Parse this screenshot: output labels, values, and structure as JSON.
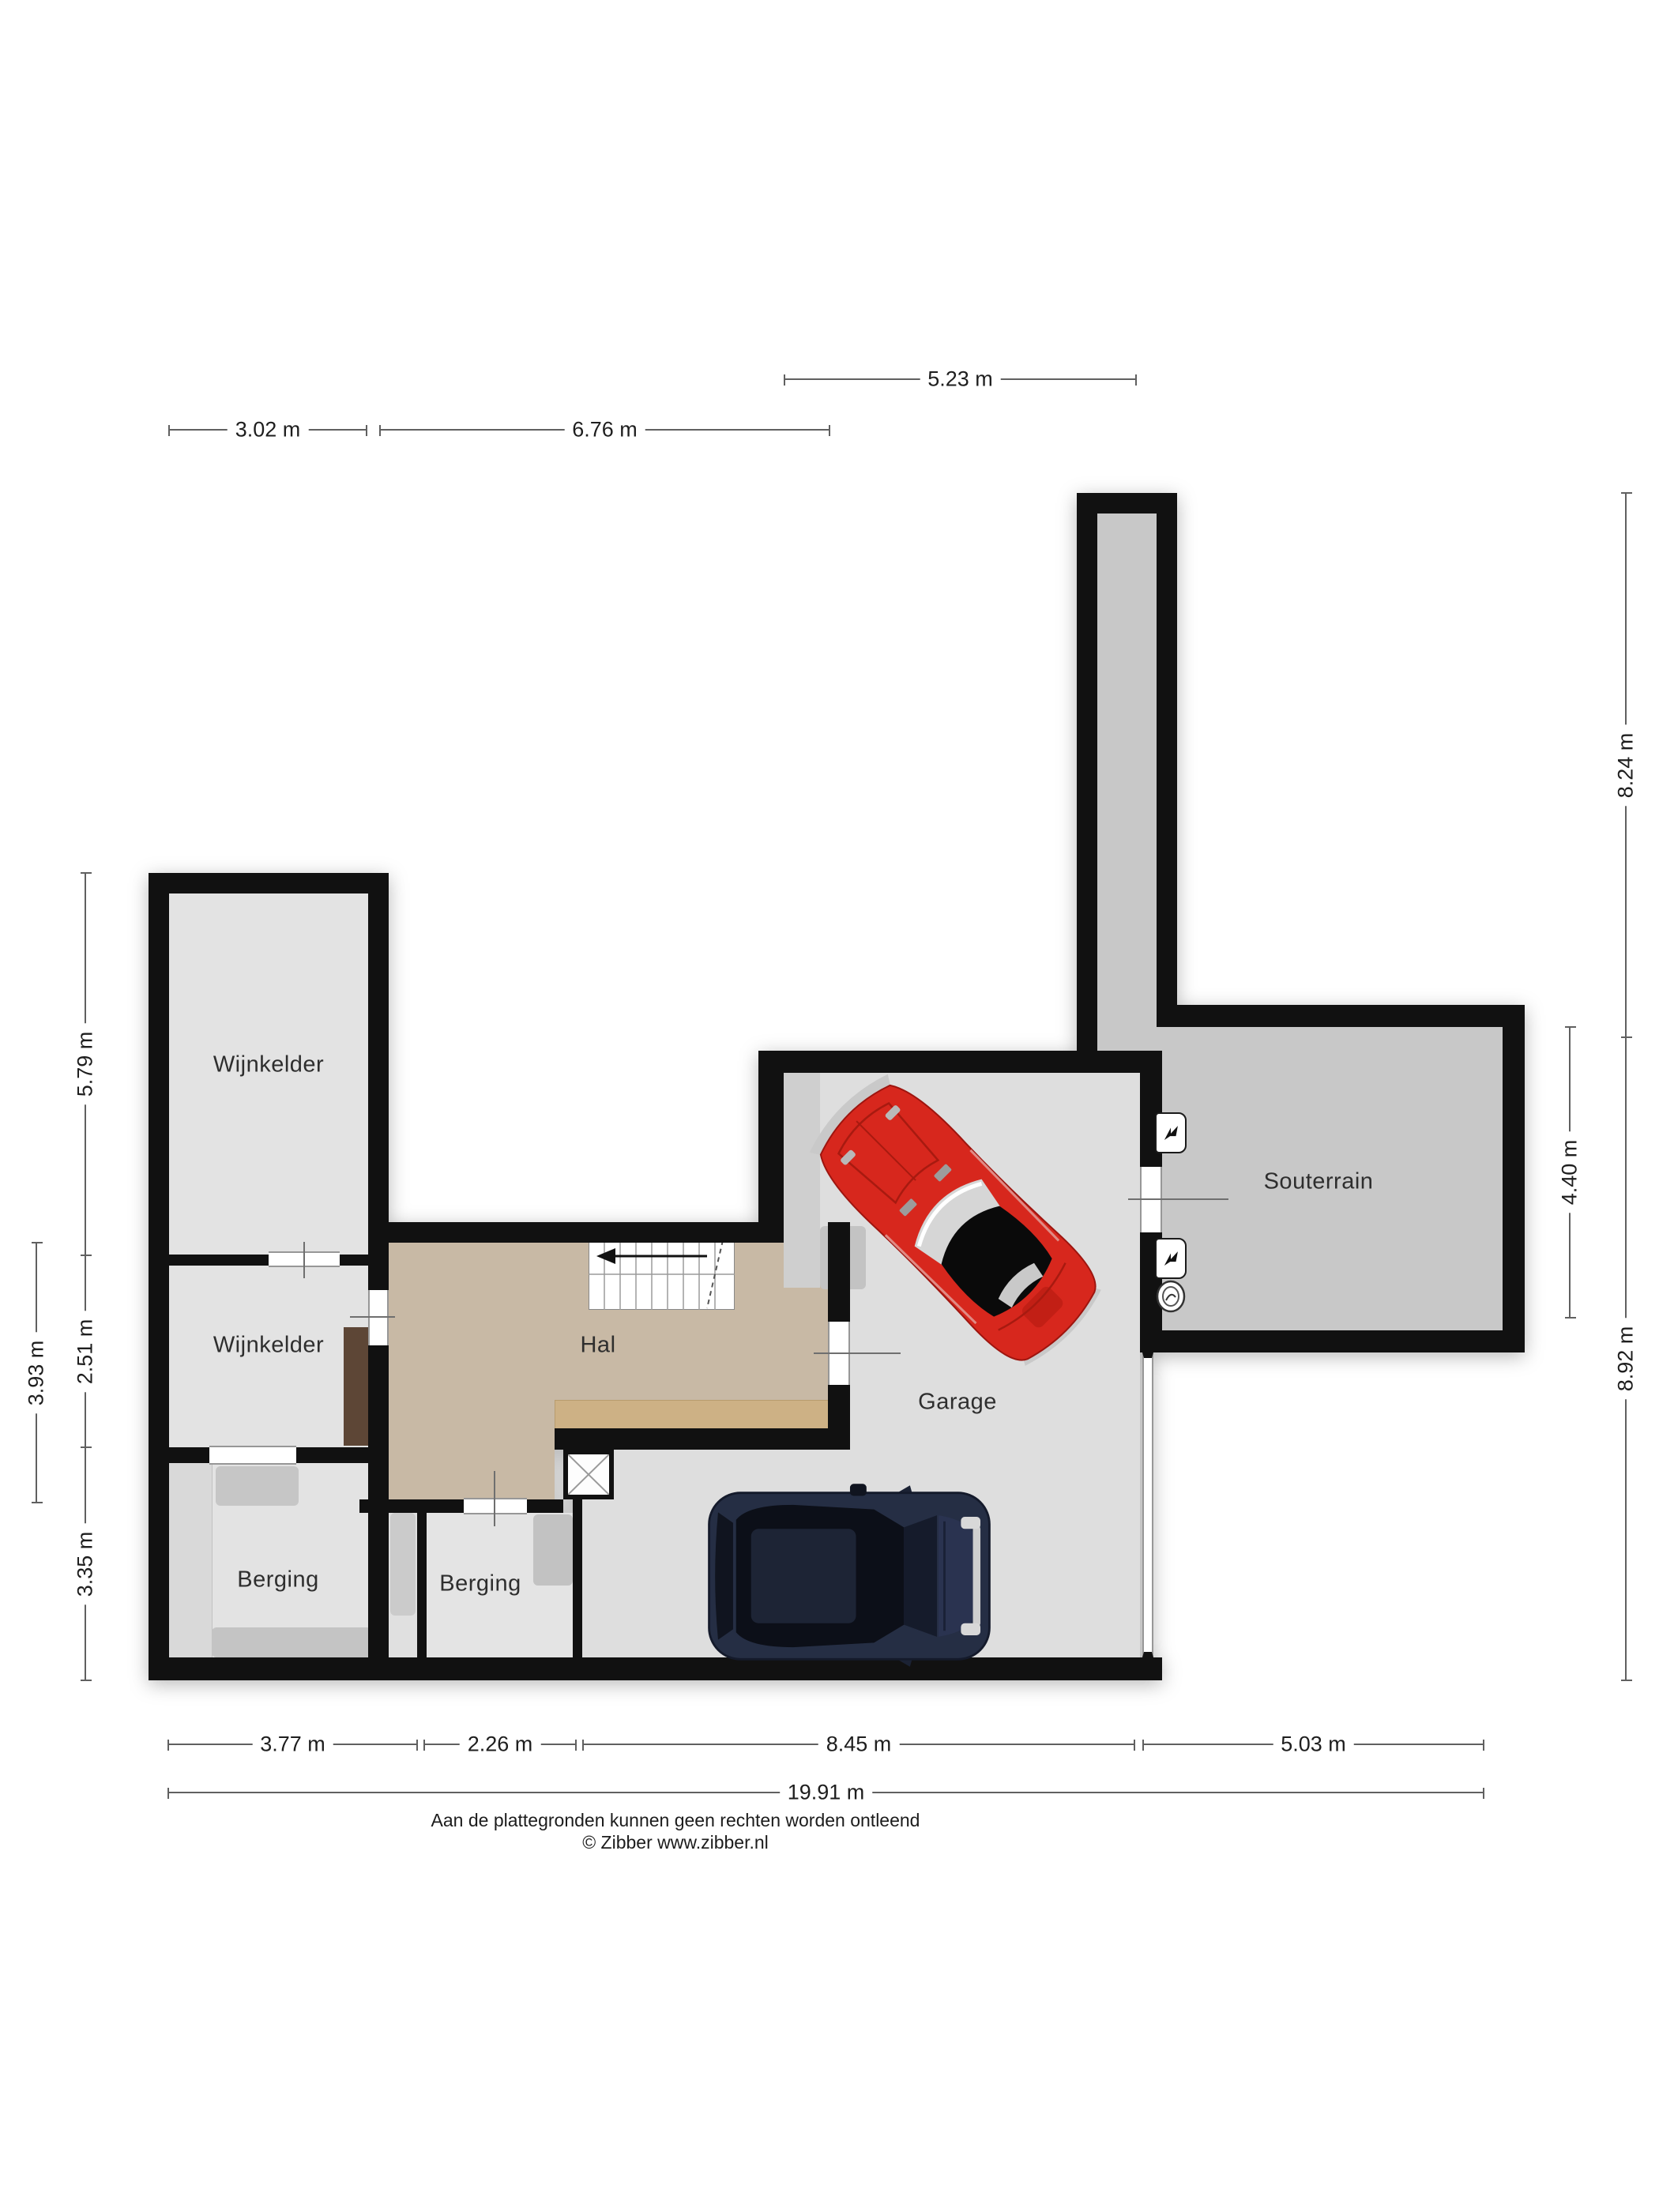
{
  "rooms": {
    "wijnkelder_top": "Wijnkelder",
    "wijnkelder_bottom": "Wijnkelder",
    "hal": "Hal",
    "berging_left": "Berging",
    "berging_middle": "Berging",
    "garage": "Garage",
    "souterrain": "Souterrain"
  },
  "dimensions": {
    "top": {
      "d1": "5.23 m",
      "d2": "3.02 m",
      "d3": "6.76 m"
    },
    "bottom": {
      "d1": "3.77 m",
      "d2": "2.26 m",
      "d3": "8.45 m",
      "d4": "5.03 m",
      "total": "19.91 m"
    },
    "left": {
      "d1": "5.79 m",
      "d2": "2.51 m",
      "d3": "3.35 m",
      "outer": "3.93 m"
    },
    "right": {
      "d1": "8.24 m",
      "d2": "4.40 m",
      "d3": "8.92 m"
    }
  },
  "footer": {
    "disclaimer": "Aan de plattegronden kunnen geen rechten worden ontleend",
    "copyright": "© Zibber www.zibber.nl"
  },
  "icons": {
    "ventilation_top": "ventilation-unit-icon",
    "ventilation_bottom": "ventilation-unit-icon",
    "meter": "meter-icon",
    "stairs_arrow": "stairs-direction-arrow"
  },
  "colors": {
    "wall": "#111111",
    "floor_light": "#e3e3e3",
    "floor_garage": "#dedede",
    "floor_dark": "#c8c8c8",
    "floor_hal": "#c8b9a5",
    "sideboard_wood": "#cdb185",
    "cabinet_wood": "#5d4636",
    "car_red": "#d7271d",
    "suv_navy": "#252e44"
  }
}
